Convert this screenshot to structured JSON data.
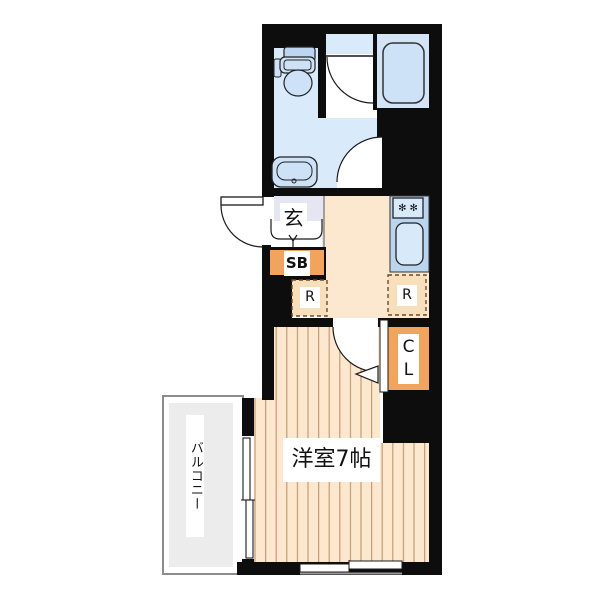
{
  "plan": {
    "kind": "apartment-floor-plan",
    "rooms": {
      "entrance": {
        "label": "玄"
      },
      "shoe_box": {
        "label": "SB"
      },
      "storage_space_left": {
        "label": "R"
      },
      "storage_space_right": {
        "label": "R"
      },
      "closet": {
        "char_top": "C",
        "char_bottom": "L"
      },
      "western_room": {
        "label": "洋室7帖"
      },
      "balcony": {
        "label": "バルコニー"
      }
    },
    "icons": {
      "stove_burners": "✻✻"
    },
    "colors": {
      "wall": "#0d0d0d",
      "water-floor": "#D9EAFA",
      "bath-floor": "#D2E4F6",
      "fixture": "#CDE2F7",
      "fixture-dark": "#BCD6F1",
      "fixture-light": "#D8E9FA",
      "counter": "#BAD5F0",
      "genkan": "#E6E5F2",
      "hall": "#FCE8CE",
      "room-bg": "#FCE8CE",
      "stripe": "#C49C74",
      "orange": "#F2A45C",
      "dash": "#6B4A26",
      "dash-fill": "#F8DFBC",
      "balcony-fill": "#ECECEC",
      "balcony-border": "#8C8C8C",
      "label-ink": "#111111"
    }
  }
}
